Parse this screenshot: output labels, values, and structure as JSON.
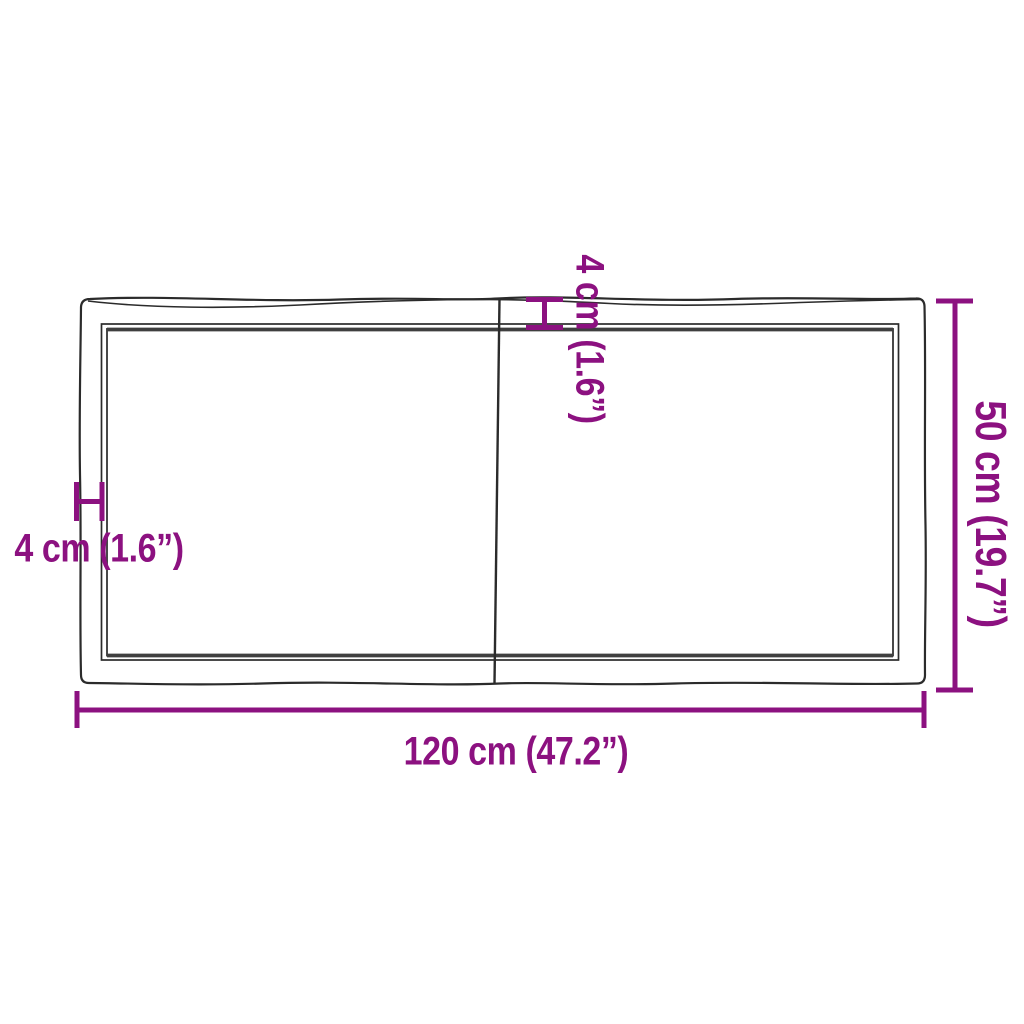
{
  "diagram": {
    "name": "tabletop-dimension-diagram",
    "description": "two-piece live-edge table top, top view with dimension markers",
    "background": "#ffffff",
    "colors": {
      "accent": "#8C1180",
      "line": "#2b2b2b",
      "line_thick": "#3f3f3f"
    },
    "dimensions": {
      "width": {
        "label": "120 cm (47.2”)",
        "cm": 120,
        "inches": 47.2
      },
      "depth": {
        "label": "50 cm (19.7”)",
        "cm": 50,
        "inches": 19.7
      },
      "thickness_left": {
        "label": "4 cm (1.6”)",
        "cm": 4,
        "inches": 1.6
      },
      "thickness_top": {
        "label": "4 cm (1.6”)",
        "cm": 4,
        "inches": 1.6
      }
    }
  }
}
